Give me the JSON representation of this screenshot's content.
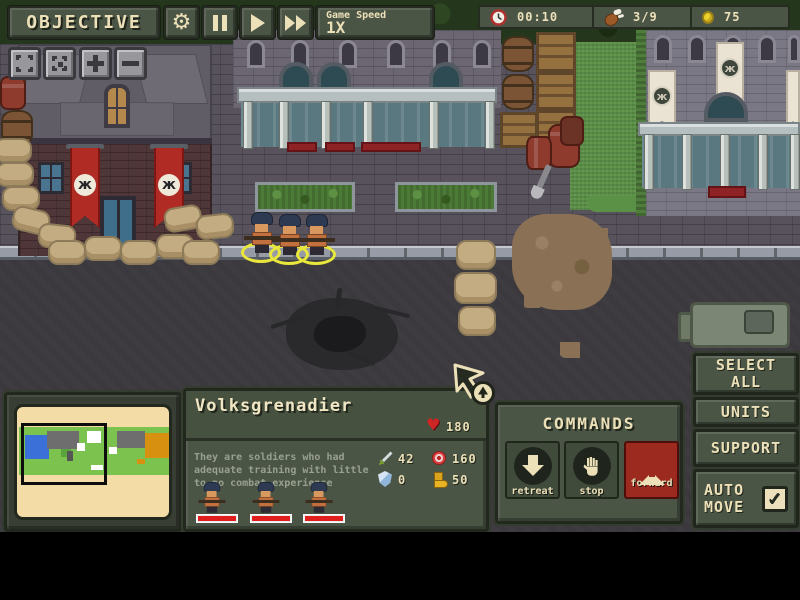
{
  "hud": {
    "objective_label": "OBJECTIVE",
    "game_speed": {
      "label": "Game Speed",
      "value": "1X"
    },
    "resources": {
      "time": "00:10",
      "rations": "3/9",
      "coins": "75"
    }
  },
  "unit_panel": {
    "name": "Volksgrenadier",
    "hp": "180",
    "description": "They are soldiers who had adequate training with little to no combat experience",
    "stats": {
      "attack": "42",
      "range": "160",
      "armor": "0",
      "cost": "50"
    }
  },
  "commands": {
    "title": "COMMANDS",
    "retreat_label": "retreat",
    "stop_label": "stop",
    "forward_label": "forward"
  },
  "side_panel": {
    "select_all_label": "SELECT ALL",
    "units_label": "UNITS",
    "support_label": "SUPPORT",
    "auto_move_label": "AUTO MOVE"
  },
  "icons": {
    "gear_glyph": "⚙",
    "heart_glyph": "♥",
    "check_glyph": "✓",
    "emblem_glyph": "ж"
  },
  "colors": {
    "panel_olive": "#4b5546",
    "cream": "#ece0b8",
    "accent_red": "#9c2a1e",
    "selection_yellow": "#e9e73c",
    "health_red": "#e01e1e"
  }
}
